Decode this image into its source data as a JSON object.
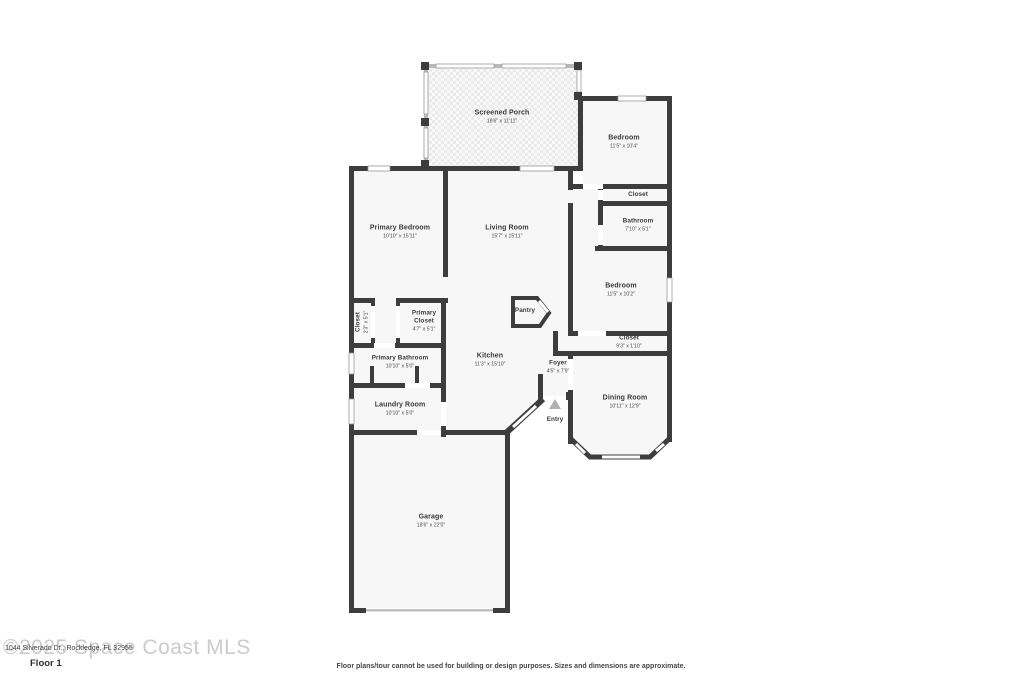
{
  "meta": {
    "watermark": "©2025 Space Coast MLS",
    "address": "1044 Silverado Dr., Rockledge, FL 32955",
    "floor_label": "Floor 1",
    "disclaimer": "Floor plans/tour cannot be used for building or design purposes. Sizes and dimensions are approximate."
  },
  "colors": {
    "wall": "#3d3d3d",
    "room_fill": "#f7f7f7",
    "window": "#ffffff",
    "entry_marker": "#b0b0b0",
    "watermark": "#cbcbcb"
  },
  "rooms": {
    "screened_porch": {
      "name": "Screened Porch",
      "dims": "18'6\" x 11'11\""
    },
    "bedroom_top": {
      "name": "Bedroom",
      "dims": "11'5\" x 10'4\""
    },
    "closet_top": {
      "name": "Closet",
      "dims": ""
    },
    "bathroom": {
      "name": "Bathroom",
      "dims": "7'10\" x 5'1\""
    },
    "bedroom_mid": {
      "name": "Bedroom",
      "dims": "11'5\" x 10'2\""
    },
    "closet_hall": {
      "name": "Closet",
      "dims": "9'3\" x 1'10\""
    },
    "primary_bedroom": {
      "name": "Primary Bedroom",
      "dims": "10'10\" x 15'11\""
    },
    "living_room": {
      "name": "Living Room",
      "dims": "15'7\" x 15'11\""
    },
    "closet_small": {
      "name": "Closet",
      "dims": "2'3\" x 5'1\""
    },
    "primary_closet": {
      "name": "Primary Closet",
      "dims": "4'7\" x 5'1\""
    },
    "pantry": {
      "name": "Pantry",
      "dims": ""
    },
    "primary_bathroom": {
      "name": "Primary Bathroom",
      "dims": "10'10\" x 5'0\""
    },
    "kitchen": {
      "name": "Kitchen",
      "dims": "11'3\" x 15'10\""
    },
    "foyer": {
      "name": "Foyer",
      "dims": "4'5\" x 7'9\""
    },
    "laundry_room": {
      "name": "Laundry Room",
      "dims": "10'10\" x 5'0\""
    },
    "dining_room": {
      "name": "Dining Room",
      "dims": "10'11\" x 12'9\""
    },
    "entry": {
      "name": "Entry",
      "dims": ""
    },
    "garage": {
      "name": "Garage",
      "dims": "18'6\" x 22'0\""
    }
  }
}
